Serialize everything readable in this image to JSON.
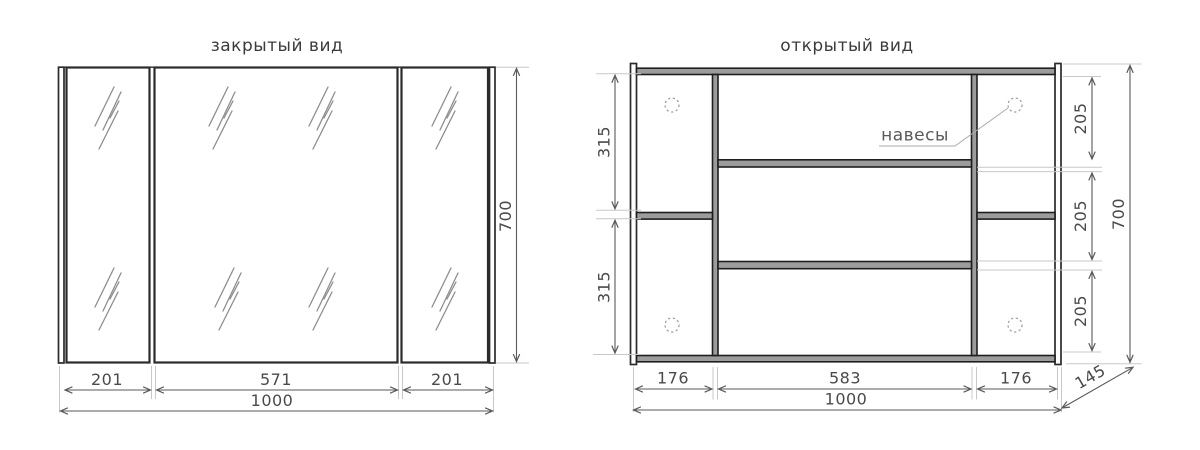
{
  "titles": {
    "closed": "закрытый вид",
    "open": "открытый вид"
  },
  "closed_view": {
    "dim_left_door": "201",
    "dim_middle_door": "571",
    "dim_right_door": "201",
    "dim_total_width": "1000",
    "dim_height": "700"
  },
  "open_view": {
    "hinge_label": "навесы",
    "dim_left_top": "315",
    "dim_left_bottom": "315",
    "dim_right_top": "205",
    "dim_right_middle": "205",
    "dim_right_bottom": "205",
    "dim_height": "700",
    "dim_left_section": "176",
    "dim_middle_section": "583",
    "dim_right_section": "176",
    "dim_total_width": "1000",
    "dim_depth": "145"
  },
  "colors": {
    "structure": "#2b2b2b",
    "panel_fill": "#9c9c9c",
    "dim_line": "#5a5a5a",
    "ext_line": "#c8c8c8",
    "text": "#4a4a4a",
    "hatch": "#8e8e8e"
  }
}
